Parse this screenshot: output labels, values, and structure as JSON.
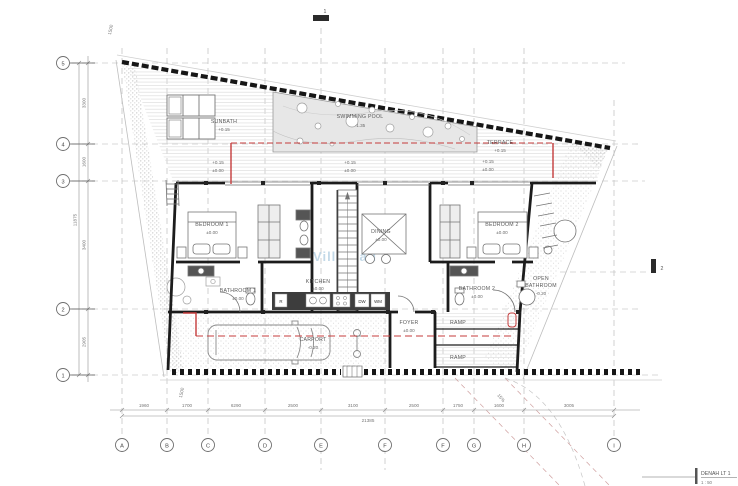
{
  "watermark": "Villa Bali",
  "title_block": {
    "title": "DENAH LT 1",
    "scale": "1 : 50"
  },
  "grid": {
    "cols": [
      "A",
      "B",
      "C",
      "D",
      "E",
      "F",
      "F",
      "G",
      "H",
      "I"
    ],
    "rows": [
      "5",
      "4",
      "3",
      "2",
      "1"
    ]
  },
  "dims": {
    "bottom": [
      "1960",
      "1700",
      "6290",
      "2500",
      "3100",
      "2500",
      "1750",
      "1600",
      "3005"
    ],
    "bottom_total": "21385",
    "left": [
      "3300",
      "1600",
      "3400",
      "2905"
    ],
    "left_total": "11875",
    "top_left": "1500",
    "bottom_left": "1500",
    "ramp_note": "15%"
  },
  "rooms": {
    "sunbath": {
      "name": "SUNBATH",
      "elev": "+0.15"
    },
    "pool": {
      "name": "SWIMMING POOL",
      "elev": "-1.35"
    },
    "terrace": {
      "name": "TERRACE",
      "elev": "+0.15"
    },
    "bedroom1": {
      "name": "BEDROOM 1",
      "elev": "±0.00"
    },
    "dining": {
      "name": "DINING",
      "elev": "±0.00"
    },
    "bedroom2": {
      "name": "BEDROOM 2",
      "elev": "±0.00"
    },
    "bathroom1": {
      "name": "BATHROOM 1",
      "elev": "±0.00"
    },
    "kitchen": {
      "name": "KITCHEN",
      "elev": "±0.00"
    },
    "bathroom2": {
      "name": "BATHROOM 2",
      "elev": "±0.00"
    },
    "open_bathroom": {
      "l1": "OPEN",
      "l2": "BATHROOM",
      "elev": "-0.20"
    },
    "carport": {
      "name": "CARPORT",
      "elev": "-0.20"
    },
    "foyer": {
      "name": "FOYER",
      "elev": "±0.00"
    },
    "ramp1": {
      "name": "RAMP"
    },
    "ramp2": {
      "name": "RAMP"
    }
  },
  "deck_marks": [
    {
      "top": "+0.15",
      "bot": "±0.00"
    },
    {
      "top": "+0.15",
      "bot": "±0.00"
    },
    {
      "top": "+0.15",
      "bot": "±0.00"
    }
  ],
  "appliances": {
    "fridge": "R",
    "dishwasher": "DW",
    "washer": "WM"
  },
  "sections": {
    "s1": "1",
    "s2": "2"
  },
  "colors": {
    "red_line": "#c43b3b",
    "pool_fill": "#e7e7e7",
    "watermark": "#b9d3e4"
  }
}
